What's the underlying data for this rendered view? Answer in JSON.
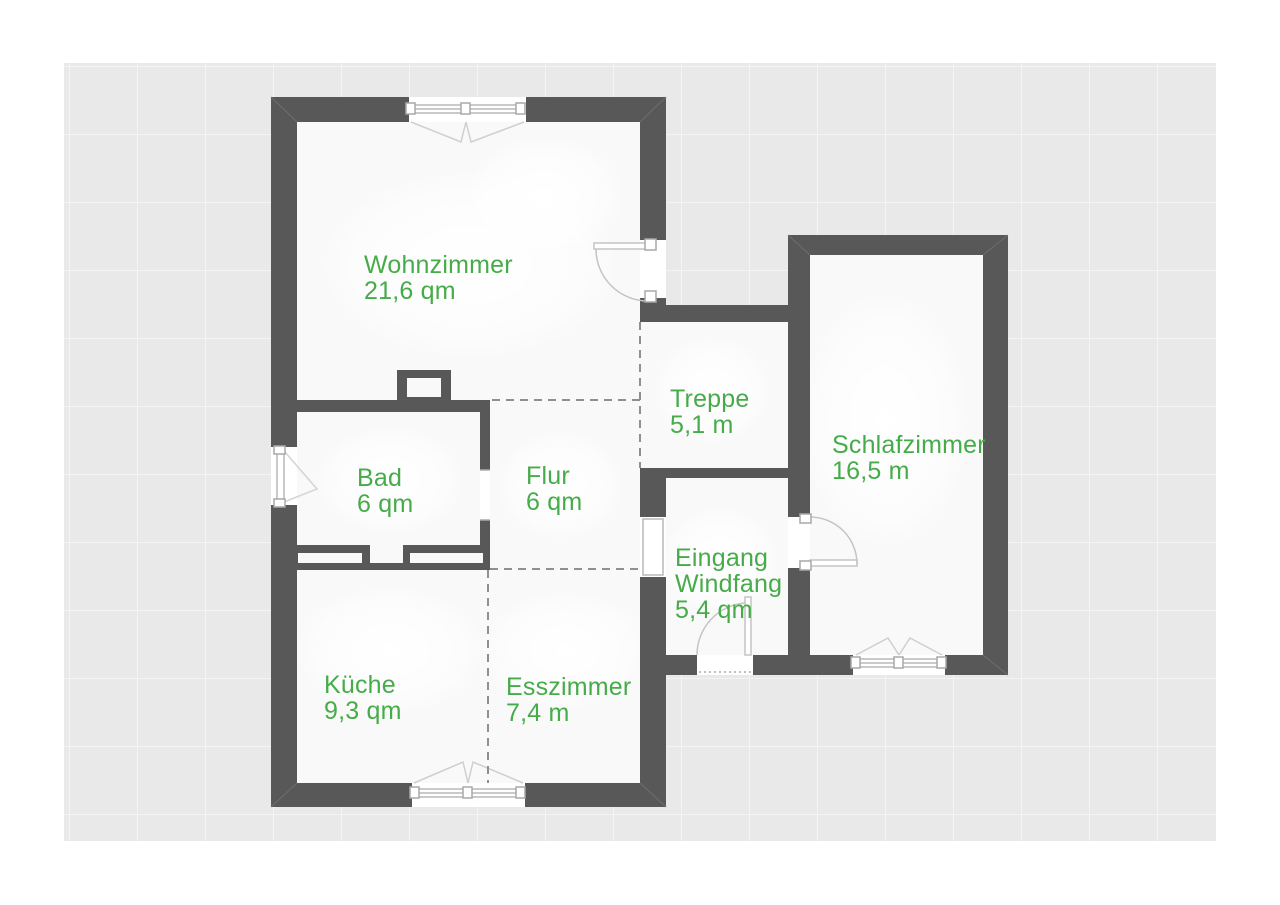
{
  "plan_title": "Grundriss",
  "canvas": {
    "background_color": "#e9e9e9",
    "grid_color": "#f4f4f4",
    "wall_color": "#585858",
    "label_color": "#46ab49"
  },
  "rooms": {
    "wohnzimmer": {
      "name": "Wohnzimmer",
      "area": "21,6 qm"
    },
    "treppe": {
      "name": "Treppe",
      "area": "5,1 m"
    },
    "schlafzimmer": {
      "name": "Schlafzimmer",
      "area": "16,5 m"
    },
    "bad": {
      "name": "Bad",
      "area": "6 qm"
    },
    "flur": {
      "name": "Flur",
      "area": "6 qm"
    },
    "eingang": {
      "name": "Eingang",
      "name2": "Windfang",
      "area": "5,4 qm"
    },
    "kueche": {
      "name": "Küche",
      "area": "9,3 qm"
    },
    "esszimmer": {
      "name": "Esszimmer",
      "area": "7,4 m"
    }
  }
}
